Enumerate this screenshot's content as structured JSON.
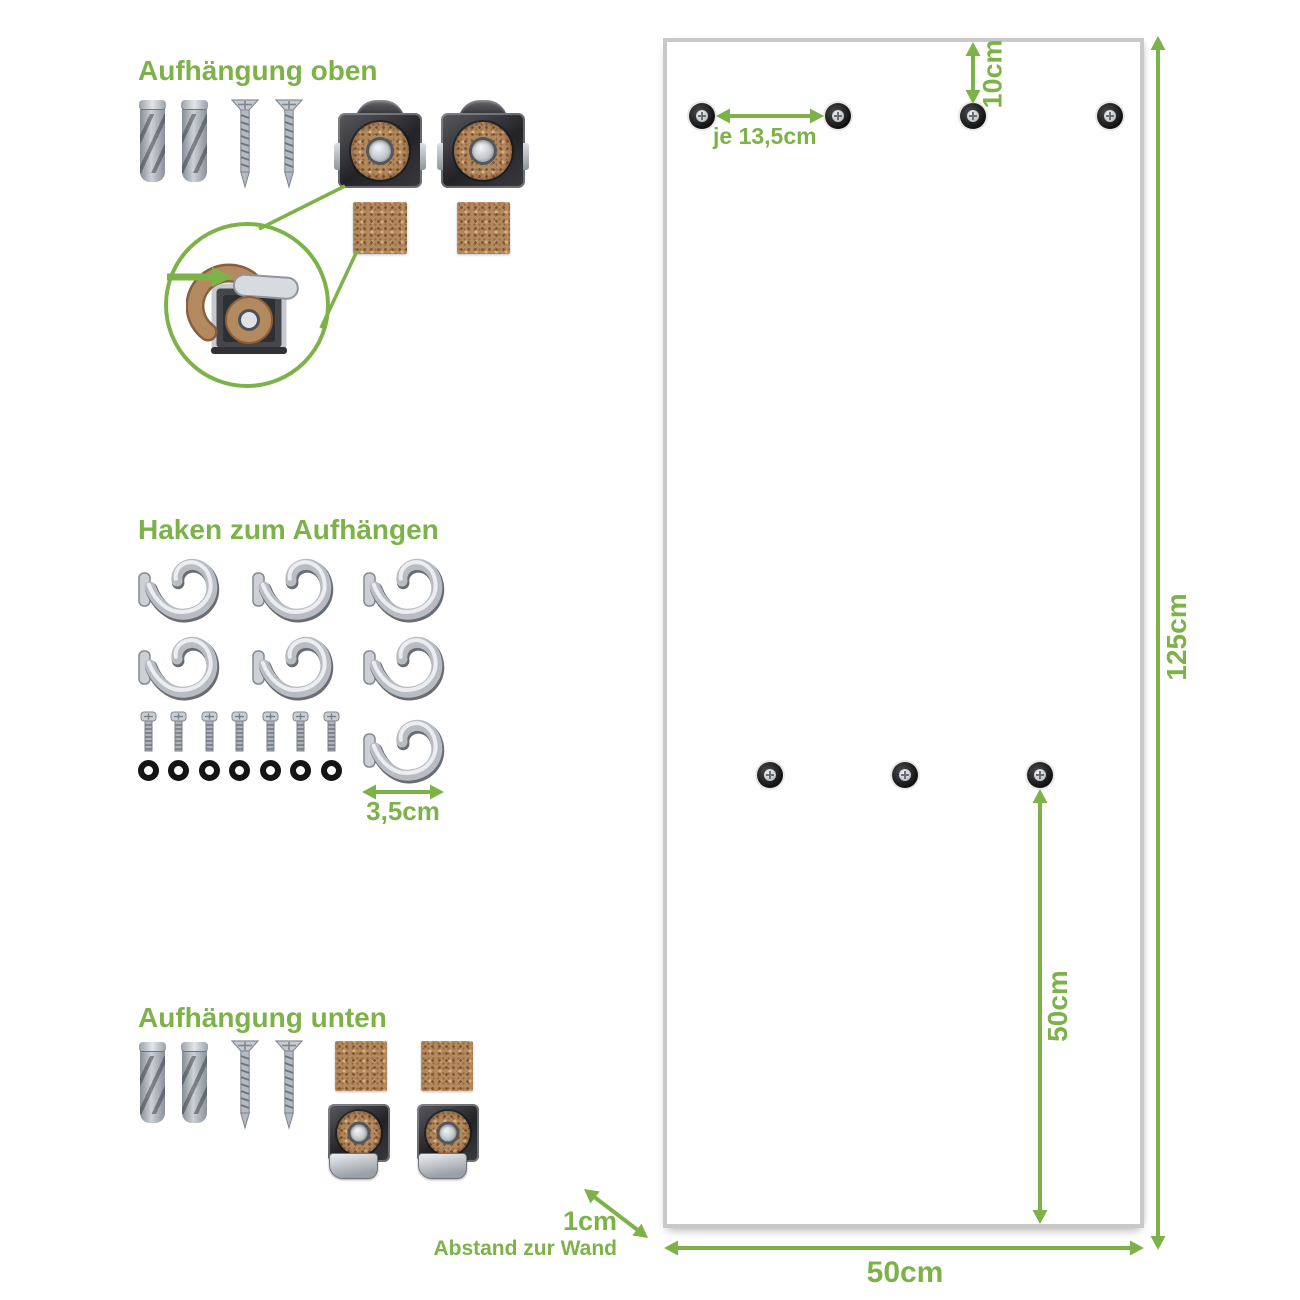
{
  "colors": {
    "accent_green": "#7db249",
    "panel_border": "#c9c9c9",
    "cork_brown": "#b3895f",
    "metal_dark": "#2a2a2e",
    "metal_light": "#c9cdd2",
    "washer_black": "#141414"
  },
  "sections": {
    "top_mount": {
      "heading": "Aufhängung oben",
      "parts": [
        {
          "item": "wall-plug",
          "qty": 2
        },
        {
          "item": "countersunk-screw",
          "qty": 2
        },
        {
          "item": "mounting-clip-with-cork-ring",
          "qty": 2
        },
        {
          "item": "cork-pad",
          "qty": 2
        }
      ],
      "detail": "clip-side-view-with-cork-strip"
    },
    "hooks": {
      "heading": "Haken zum Aufhängen",
      "size_label": "3,5cm",
      "counts": {
        "hooks": 7,
        "screws": 7,
        "washers": 7
      }
    },
    "bottom_mount": {
      "heading": "Aufhängung unten",
      "parts": [
        {
          "item": "wall-plug",
          "qty": 2
        },
        {
          "item": "countersunk-screw",
          "qty": 2
        },
        {
          "item": "cork-pad",
          "qty": 2
        },
        {
          "item": "mounting-clip-with-cork-ring",
          "qty": 2
        }
      ]
    }
  },
  "panel": {
    "dims": {
      "height": "125cm",
      "width": "50cm",
      "top_offset": "10cm",
      "hole_spacing": "je 13,5cm",
      "bottom_row": "50cm",
      "wall_gap": "1cm",
      "wall_gap_caption": "Abstand zur Wand"
    },
    "mount_points": {
      "top_row_count": 4,
      "middle_row_count": 3
    }
  }
}
